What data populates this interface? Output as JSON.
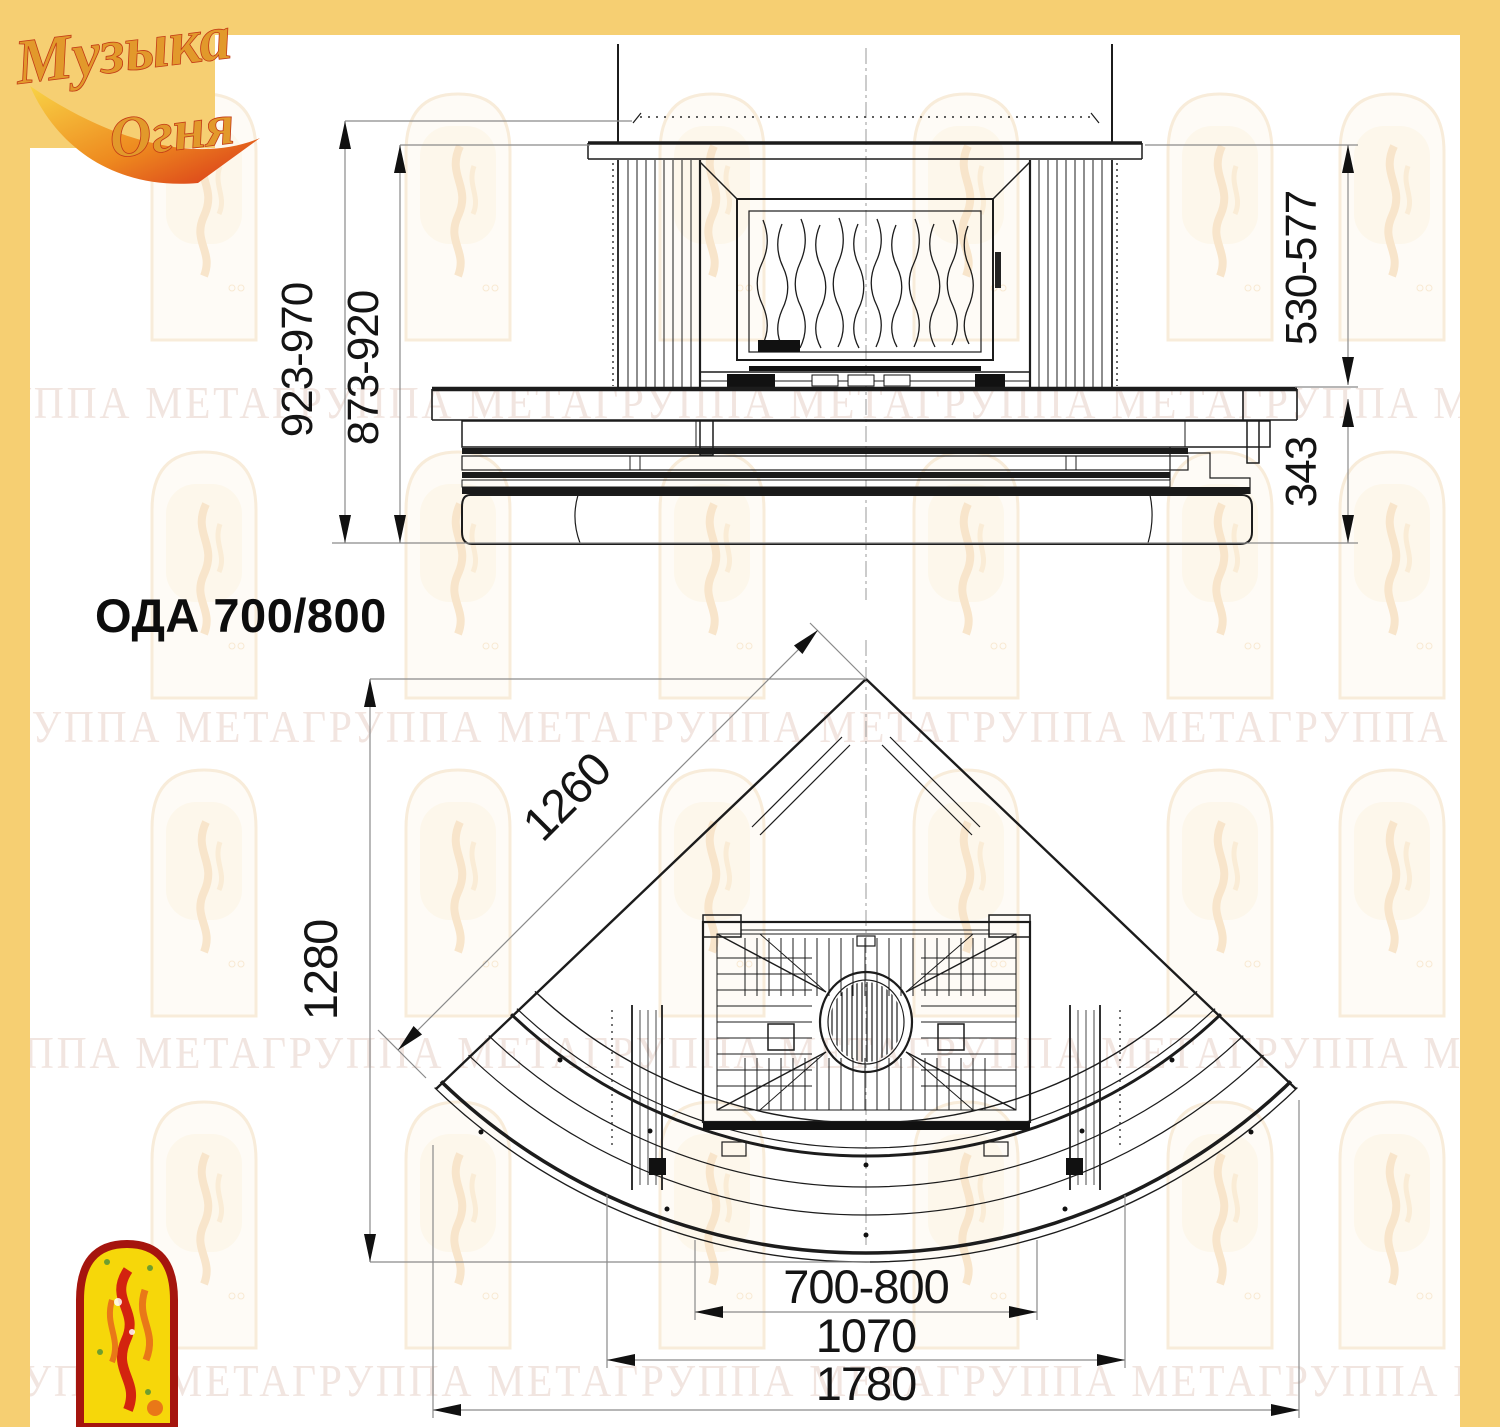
{
  "page": {
    "width": 1500,
    "height": 1427,
    "background": "#FFFFFF",
    "frame_color": "#F6CF72"
  },
  "logo": {
    "line1": "Музыка",
    "line2": "Огня"
  },
  "title": "ОДА 700/800",
  "dimensions": {
    "front": {
      "height_overall": "923-970",
      "height_inner": "873-920",
      "firebox_zone": "530-577",
      "base_height": "343"
    },
    "plan": {
      "diagonal": "1260",
      "depth": "1280",
      "opening_width": "700-800",
      "mid_width": "1070",
      "overall_width": "1780"
    }
  },
  "watermark": {
    "text": "ГРУППА МЕТАГРУППА МЕТАГРУППА МЕТАГРУППА МЕТАГРУППА МЕТА"
  },
  "colors": {
    "frame_yellow": "#F6CF72",
    "drawing_line": "#1C1C1C",
    "dimension_line": "#8A8A8A",
    "watermark_text": "#E7D0C7",
    "watermark_arch": "#F2DCBC",
    "logo_gold": "#E2992B",
    "logo_red": "#C33A16",
    "emblem_yellow": "#F6D70A",
    "emblem_red": "#A5150E"
  }
}
